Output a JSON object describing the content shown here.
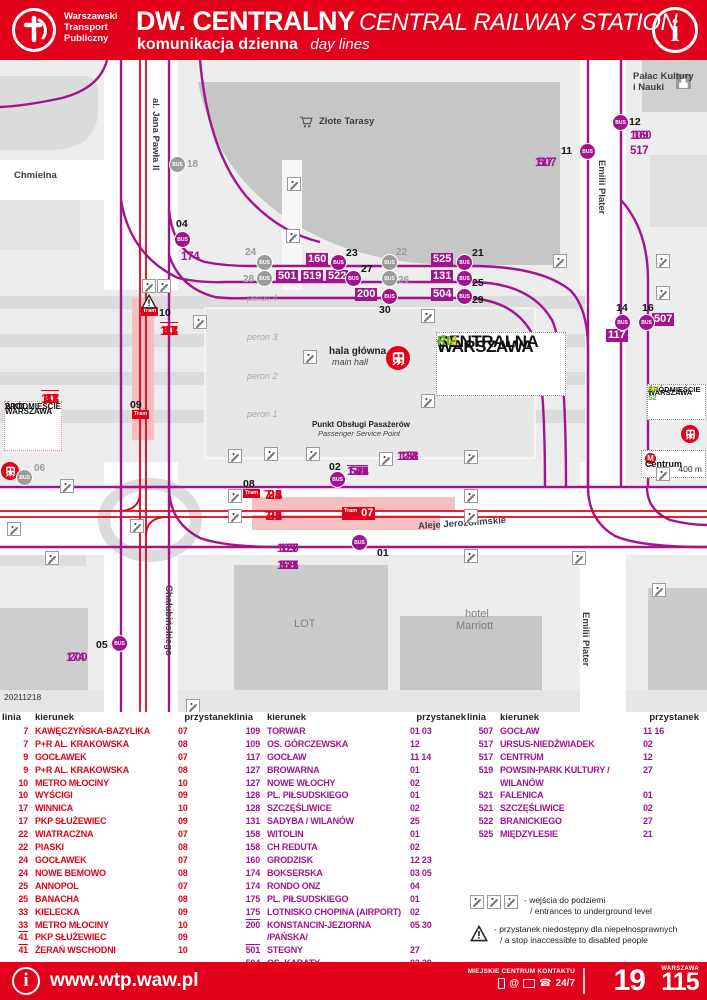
{
  "colors": {
    "red": "#e2001a",
    "magenta": "#a1148e",
    "gray": "#9b9b9b",
    "km_yellow": "#bfd000",
    "rl_green": "#6ab023"
  },
  "header": {
    "org": [
      "Warszawski",
      "Transport",
      "Publiczny"
    ],
    "title_pl": "DW. CENTRALNY",
    "title_en": "CENTRAL RAILWAY STATION",
    "subtitle_pl": "komunikacja dzienna",
    "subtitle_en": "day lines",
    "info_glyph": "i"
  },
  "map": {
    "date_code": "20211218",
    "streets": [
      {
        "t": "Chmielna",
        "x": 14,
        "y": 110,
        "vert": false
      },
      {
        "t": "al. Jana Pawła II",
        "x": 150,
        "y": 38,
        "vert": true
      },
      {
        "t": "Emilii Plater",
        "x": 596,
        "y": 100,
        "vert": true
      },
      {
        "t": "Emilii Plater",
        "x": 580,
        "y": 552,
        "vert": true
      },
      {
        "t": "Chałubińskiego",
        "x": 163,
        "y": 525,
        "vert": true
      },
      {
        "t": "Aleje Jerozolimskie",
        "x": 418,
        "y": 458,
        "rot": -4,
        "vert": false
      },
      {
        "t": "Złote Tarasy",
        "x": 319,
        "y": 56,
        "vert": false
      },
      {
        "t": "Pałac Kultury",
        "x": 633,
        "y": 11,
        "vert": false
      },
      {
        "t": "i Nauki",
        "x": 633,
        "y": 22,
        "vert": false
      }
    ],
    "perons": [
      {
        "t": "peron 4",
        "x": 247,
        "y": 233
      },
      {
        "t": "peron 3",
        "x": 247,
        "y": 272
      },
      {
        "t": "peron 2",
        "x": 247,
        "y": 311
      },
      {
        "t": "peron 1",
        "x": 247,
        "y": 349
      }
    ],
    "buildings": [
      {
        "t": "LOT",
        "x": 294,
        "y": 558
      },
      {
        "t": "hotel",
        "x": 465,
        "y": 548
      },
      {
        "t": "Marriott",
        "x": 456,
        "y": 560
      }
    ],
    "hala": {
      "pl": "hala główna",
      "en": "main hall"
    },
    "punkt": {
      "pl": "Punkt Obsługi Pasażerów",
      "en": "Passenger Service Point"
    },
    "boxes": {
      "wkd": {
        "l1": "WARSZAWA",
        "l2": "ŚRÓDMIEŚCIE",
        "l3": "WKD"
      },
      "centralna": {
        "l1": "WARSZAWA",
        "l2": "CENTRALNA",
        "l3a": "KM",
        "l3b": "RL"
      },
      "srodmiescie": {
        "l1": "WARSZAWA",
        "l2": "ŚRÓDMIEŚCIE",
        "l3a": "S1 S2",
        "l3b": "KM"
      },
      "centrum": {
        "name": "Centrum",
        "arrow": "→",
        "dist": "400 m"
      }
    },
    "line_lists": [
      {
        "t": "174",
        "x": 181,
        "y": 191,
        "c": "m",
        "ovl": []
      },
      {
        "t": "109 160",
        "x": 630,
        "y": 70,
        "c": "m",
        "ovl": []
      },
      {
        "t": "517",
        "x": 630,
        "y": 85,
        "c": "m",
        "ovl": []
      },
      {
        "t": "117 507",
        "x": 535,
        "y": 97,
        "c": "m",
        "ovl": []
      },
      {
        "t": "127 128 131 158",
        "x": 397,
        "y": 391,
        "c": "m",
        "ovl": []
      },
      {
        "t": "175 501 504 517 519 521 522 525",
        "x": 347,
        "y": 406,
        "c": "m",
        "ovl": [
          "501"
        ]
      },
      {
        "t": "109 127 128",
        "x": 277,
        "y": 483,
        "c": "m",
        "ovl": []
      },
      {
        "t": "158 175 517 521",
        "x": 277,
        "y": 500,
        "c": "m",
        "ovl": []
      },
      {
        "t": "174 200",
        "x": 66,
        "y": 592,
        "c": "m",
        "ovl": []
      },
      {
        "t": "10 17 33 41",
        "x": 160,
        "y": 263,
        "c": "r",
        "ovl": [
          "41"
        ]
      },
      {
        "t": "10 17 33 41",
        "x": 41,
        "y": 331,
        "c": "r",
        "ovl": [
          "41"
        ]
      },
      {
        "t": "7 9 22 24 25",
        "x": 264,
        "y": 427,
        "c": "r",
        "ovl": []
      },
      {
        "t": "7 9 22 24 25",
        "x": 264,
        "y": 448,
        "c": "r",
        "ovl": []
      }
    ],
    "stop_numbers": [
      {
        "t": "04",
        "x": 176,
        "y": 158
      },
      {
        "t": "12",
        "x": 629,
        "y": 56
      },
      {
        "t": "11",
        "x": 561,
        "y": 85
      },
      {
        "t": "23",
        "x": 346,
        "y": 187
      },
      {
        "t": "27",
        "x": 361,
        "y": 203
      },
      {
        "t": "30",
        "x": 379,
        "y": 244
      },
      {
        "t": "21",
        "x": 472,
        "y": 187
      },
      {
        "t": "25",
        "x": 472,
        "y": 217
      },
      {
        "t": "29",
        "x": 472,
        "y": 234
      },
      {
        "t": "14",
        "x": 616,
        "y": 242
      },
      {
        "t": "16",
        "x": 642,
        "y": 242
      },
      {
        "t": "02",
        "x": 329,
        "y": 401
      },
      {
        "t": "08",
        "x": 243,
        "y": 418
      },
      {
        "t": "01",
        "x": 377,
        "y": 487
      },
      {
        "t": "05",
        "x": 96,
        "y": 579
      },
      {
        "t": "10",
        "x": 159,
        "y": 247
      },
      {
        "t": "09",
        "x": 130,
        "y": 339
      }
    ],
    "gray_numbers": [
      {
        "t": "18",
        "x": 187,
        "y": 99
      },
      {
        "t": "24",
        "x": 245,
        "y": 187
      },
      {
        "t": "28",
        "x": 243,
        "y": 214
      },
      {
        "t": "22",
        "x": 396,
        "y": 187
      },
      {
        "t": "26",
        "x": 398,
        "y": 215
      },
      {
        "t": "06",
        "x": 34,
        "y": 403
      }
    ],
    "line_boxes": [
      {
        "t": "160",
        "x": 306,
        "y": 193
      },
      {
        "t": "501",
        "x": 276,
        "y": 210
      },
      {
        "t": "519",
        "x": 301,
        "y": 210
      },
      {
        "t": "522",
        "x": 326,
        "y": 210
      },
      {
        "t": "200",
        "x": 355,
        "y": 228
      },
      {
        "t": "525",
        "x": 431,
        "y": 193
      },
      {
        "t": "131",
        "x": 431,
        "y": 210
      },
      {
        "t": "504",
        "x": 431,
        "y": 228
      },
      {
        "t": "117",
        "x": 606,
        "y": 269
      },
      {
        "t": "507",
        "x": 652,
        "y": 253
      }
    ],
    "bus_stops": [
      {
        "x": 182,
        "y": 179,
        "gray": false
      },
      {
        "x": 338,
        "y": 202,
        "gray": false
      },
      {
        "x": 353,
        "y": 218,
        "gray": false
      },
      {
        "x": 389,
        "y": 236,
        "gray": false
      },
      {
        "x": 464,
        "y": 202,
        "gray": false
      },
      {
        "x": 464,
        "y": 218,
        "gray": false
      },
      {
        "x": 464,
        "y": 236,
        "gray": false
      },
      {
        "x": 587,
        "y": 91,
        "gray": false
      },
      {
        "x": 620,
        "y": 62,
        "gray": false
      },
      {
        "x": 622,
        "y": 262,
        "gray": false
      },
      {
        "x": 646,
        "y": 262,
        "gray": false
      },
      {
        "x": 337,
        "y": 419,
        "gray": false
      },
      {
        "x": 359,
        "y": 482,
        "gray": false
      },
      {
        "x": 119,
        "y": 583,
        "gray": false
      },
      {
        "x": 177,
        "y": 104,
        "gray": true
      },
      {
        "x": 264,
        "y": 202,
        "gray": true
      },
      {
        "x": 264,
        "y": 218,
        "gray": true
      },
      {
        "x": 389,
        "y": 202,
        "gray": true
      },
      {
        "x": 389,
        "y": 218,
        "gray": true
      },
      {
        "x": 24,
        "y": 417,
        "gray": true
      }
    ],
    "tram_badge_label": "Tram",
    "tram_badges": [
      {
        "x": 141,
        "y": 247
      },
      {
        "x": 132,
        "y": 350
      },
      {
        "x": 243,
        "y": 429
      }
    ],
    "stop07": {
      "badge": "Tram",
      "num": "07",
      "x": 342,
      "y": 447
    },
    "stairs": [
      [
        287,
        117
      ],
      [
        286,
        169
      ],
      [
        193,
        255
      ],
      [
        142,
        219
      ],
      [
        157,
        219
      ],
      [
        303,
        290
      ],
      [
        421,
        249
      ],
      [
        421,
        334
      ],
      [
        553,
        194
      ],
      [
        656,
        194
      ],
      [
        656,
        226
      ],
      [
        228,
        389
      ],
      [
        264,
        387
      ],
      [
        306,
        387
      ],
      [
        379,
        392
      ],
      [
        228,
        429
      ],
      [
        228,
        449
      ],
      [
        464,
        390
      ],
      [
        464,
        429
      ],
      [
        464,
        449
      ],
      [
        464,
        489
      ],
      [
        572,
        491
      ],
      [
        656,
        407
      ],
      [
        60,
        419
      ],
      [
        130,
        459
      ],
      [
        7,
        462
      ],
      [
        45,
        491
      ],
      [
        652,
        523
      ],
      [
        186,
        639
      ]
    ],
    "warn": [
      [
        141,
        234
      ]
    ]
  },
  "table": {
    "headers": {
      "linia": "linia",
      "kierunek": "kierunek",
      "przystanek": "przystanek"
    },
    "columns": [
      {
        "color": "red",
        "rows": [
          {
            "l": "7",
            "k": "KAWĘCZYŃSKA-BAZYLIKA",
            "p": "07",
            "ovl": false
          },
          {
            "l": "7",
            "k": "P+R AL. KRAKOWSKA",
            "p": "08",
            "ovl": false
          },
          {
            "l": "9",
            "k": "GOCŁAWEK",
            "p": "07",
            "ovl": false
          },
          {
            "l": "9",
            "k": "P+R AL. KRAKOWSKA",
            "p": "08",
            "ovl": false
          },
          {
            "l": "10",
            "k": "METRO MŁOCINY",
            "p": "10",
            "ovl": false
          },
          {
            "l": "10",
            "k": "WYŚCIGI",
            "p": "09",
            "ovl": false
          },
          {
            "l": "17",
            "k": "WINNICA",
            "p": "10",
            "ovl": false
          },
          {
            "l": "17",
            "k": "PKP SŁUŻEWIEC",
            "p": "09",
            "ovl": false
          },
          {
            "l": "22",
            "k": "WIATRACZNA",
            "p": "07",
            "ovl": false
          },
          {
            "l": "22",
            "k": "PIASKI",
            "p": "08",
            "ovl": false
          },
          {
            "l": "24",
            "k": "GOCŁAWEK",
            "p": "07",
            "ovl": false
          },
          {
            "l": "24",
            "k": "NOWE BEMOWO",
            "p": "08",
            "ovl": false
          },
          {
            "l": "25",
            "k": "ANNOPOL",
            "p": "07",
            "ovl": false
          },
          {
            "l": "25",
            "k": "BANACHA",
            "p": "08",
            "ovl": false
          },
          {
            "l": "33",
            "k": "KIELECKA",
            "p": "09",
            "ovl": false
          },
          {
            "l": "33",
            "k": "METRO MŁOCINY",
            "p": "10",
            "ovl": false
          },
          {
            "l": "41",
            "k": "PKP SŁUŻEWIEC",
            "p": "09",
            "ovl": true
          },
          {
            "l": "41",
            "k": "ŻERAŃ WSCHODNI",
            "p": "10",
            "ovl": true
          }
        ]
      },
      {
        "color": "mag",
        "rows": [
          {
            "l": "109",
            "k": "TORWAR",
            "p": "01 03",
            "ovl": false
          },
          {
            "l": "109",
            "k": "OS. GÓRCZEWSKA",
            "p": "12",
            "ovl": false
          },
          {
            "l": "117",
            "k": "GOCŁAW",
            "p": "11 14",
            "ovl": false
          },
          {
            "l": "127",
            "k": "BROWARNA",
            "p": "01",
            "ovl": false
          },
          {
            "l": "127",
            "k": "NOWE WŁOCHY",
            "p": "02",
            "ovl": false
          },
          {
            "l": "128",
            "k": "PL. PIŁSUDSKIEGO",
            "p": "01",
            "ovl": false
          },
          {
            "l": "128",
            "k": "SZCZĘŚLIWICE",
            "p": "02",
            "ovl": false
          },
          {
            "l": "131",
            "k": "SADYBA / WILANÓW",
            "p": "25",
            "ovl": false
          },
          {
            "l": "158",
            "k": "WITOLIN",
            "p": "01",
            "ovl": false
          },
          {
            "l": "158",
            "k": "CH REDUTA",
            "p": "02",
            "ovl": false
          },
          {
            "l": "160",
            "k": "GRODZISK",
            "p": "12 23",
            "ovl": false
          },
          {
            "l": "174",
            "k": "BOKSERSKA",
            "p": "03 05",
            "ovl": false
          },
          {
            "l": "174",
            "k": "RONDO ONZ",
            "p": "04",
            "ovl": false
          },
          {
            "l": "175",
            "k": "PL. PIŁSUDSKIEGO",
            "p": "01",
            "ovl": false
          },
          {
            "l": "175",
            "k": "LOTNISKO CHOPINA (AIRPORT)",
            "p": "02",
            "ovl": false
          },
          {
            "l": "200",
            "k": "KONSTANCIN-JEZIORNA /PAŃSKA/",
            "p": "05 30",
            "ovl": true
          },
          {
            "l": "501",
            "k": "STEGNY",
            "p": "27",
            "ovl": true
          },
          {
            "l": "504",
            "k": "OS. KABATY",
            "p": "02 29",
            "ovl": false
          }
        ]
      },
      {
        "color": "mag",
        "rows": [
          {
            "l": "507",
            "k": "GOCŁAW",
            "p": "11 16",
            "ovl": false
          },
          {
            "l": "517",
            "k": "URSUS-NIEDŹWIADEK",
            "p": "02",
            "ovl": false
          },
          {
            "l": "517",
            "k": "CENTRUM",
            "p": "12",
            "ovl": false
          },
          {
            "l": "519",
            "k": "POWSIN-PARK KULTURY / WILANÓW",
            "p": "27",
            "ovl": false
          },
          {
            "l": "521",
            "k": "FALENICA",
            "p": "01",
            "ovl": false
          },
          {
            "l": "521",
            "k": "SZCZĘŚLIWICE",
            "p": "02",
            "ovl": false
          },
          {
            "l": "522",
            "k": "BRANICKIEGO",
            "p": "27",
            "ovl": false
          },
          {
            "l": "525",
            "k": "MIĘDZYLESIE",
            "p": "21",
            "ovl": false
          }
        ]
      }
    ],
    "legend": {
      "stairs_pl": "- wejścia do podziemi",
      "stairs_en": "/ entrances to underground level",
      "warn_pl": "- przystanek niedostępny dla niepełnosprawnych",
      "warn_en": "/ a stop inaccessible to disabled people"
    }
  },
  "footer": {
    "url": "www.wtp.waw.pl",
    "contact_label": "MIEJSKIE CENTRUM KONTAKTU",
    "hours": "24/7",
    "at": "@",
    "phone_glyph": "☎",
    "num_19": "19",
    "num_city": "WARSZAWA",
    "num_115": "115"
  }
}
